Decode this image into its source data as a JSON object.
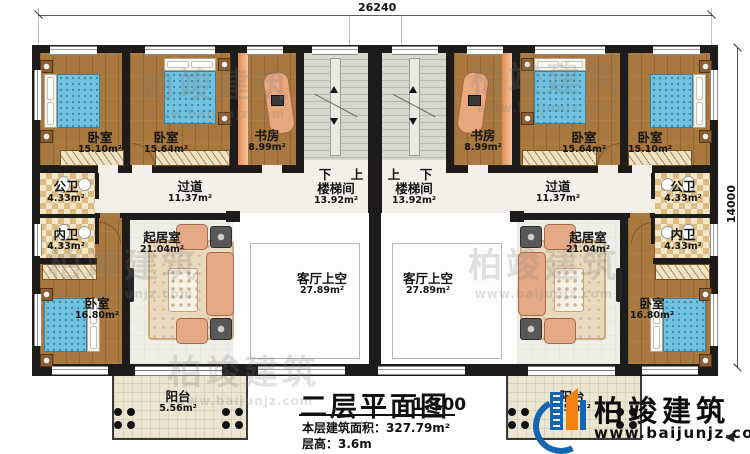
{
  "dimensions": {
    "top": "26240",
    "right": "14000"
  },
  "stairs": {
    "left": {
      "down": "下",
      "up": "上"
    },
    "right": {
      "up": "上",
      "down": "下"
    }
  },
  "rooms": {
    "left": {
      "bedroom1": {
        "name": "卧室",
        "area": "15.10m²"
      },
      "bedroom2": {
        "name": "卧室",
        "area": "15.64m²"
      },
      "study": {
        "name": "书房",
        "area": "8.99m²"
      },
      "stairwell": {
        "name": "楼梯间",
        "area": "13.92m²"
      },
      "public_bath": {
        "name": "公卫",
        "area": "4.33m²"
      },
      "corridor": {
        "name": "过道",
        "area": "11.37m²"
      },
      "private_bath": {
        "name": "内卫",
        "area": "4.33m²"
      },
      "living": {
        "name": "起居室",
        "area": "21.04m²"
      },
      "living_void": {
        "name": "客厅上空",
        "area": "27.89m²"
      },
      "bedroom3": {
        "name": "卧室",
        "area": "16.80m²"
      },
      "balcony": {
        "name": "阳台",
        "area": "5.56m²"
      }
    },
    "right": {
      "bedroom1": {
        "name": "卧室",
        "area": "15.10m²"
      },
      "bedroom2": {
        "name": "卧室",
        "area": "15.64m²"
      },
      "study": {
        "name": "书房",
        "area": "8.99m²"
      },
      "stairwell": {
        "name": "楼梯间",
        "area": "13.92m²"
      },
      "public_bath": {
        "name": "公卫",
        "area": "4.33m²"
      },
      "corridor": {
        "name": "过道",
        "area": "11.37m²"
      },
      "private_bath": {
        "name": "内卫",
        "area": "4.33m²"
      },
      "living": {
        "name": "起居室",
        "area": "21.04m²"
      },
      "living_void": {
        "name": "客厅上空",
        "area": "27.89m²"
      },
      "bedroom3": {
        "name": "卧室",
        "area": "16.80m²"
      },
      "balcony": {
        "name": "阳台",
        "area": "5.56m²"
      }
    }
  },
  "title_block": {
    "title": "二层平面图",
    "scale": "1:100",
    "area_line": "本层建筑面积：327.79m²",
    "floor_height_line": "层高：3.6m"
  },
  "brand": {
    "name": "柏竣建筑",
    "url": "www.baijunjz.com"
  },
  "watermark": {
    "text": "柏竣建筑",
    "url": "www.baijunjz.com"
  }
}
